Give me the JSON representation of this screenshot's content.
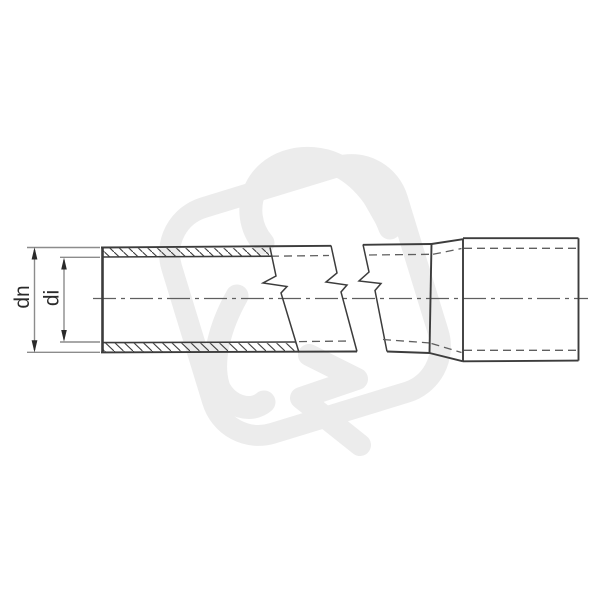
{
  "diagram": {
    "type": "technical-line-drawing",
    "subject": "rigid pipe with socket end, shown in part section with length break",
    "labels": {
      "outer_diameter": "dn",
      "inner_diameter": "di"
    },
    "colors": {
      "background": "#ffffff",
      "outline": "#3c3c3c",
      "hidden_line": "#5f5f5f",
      "center_line": "#5f5f5f",
      "dimension_line": "#8c8c8c",
      "arrow": "#2a2a2a",
      "watermark": "#ececec"
    }
  }
}
